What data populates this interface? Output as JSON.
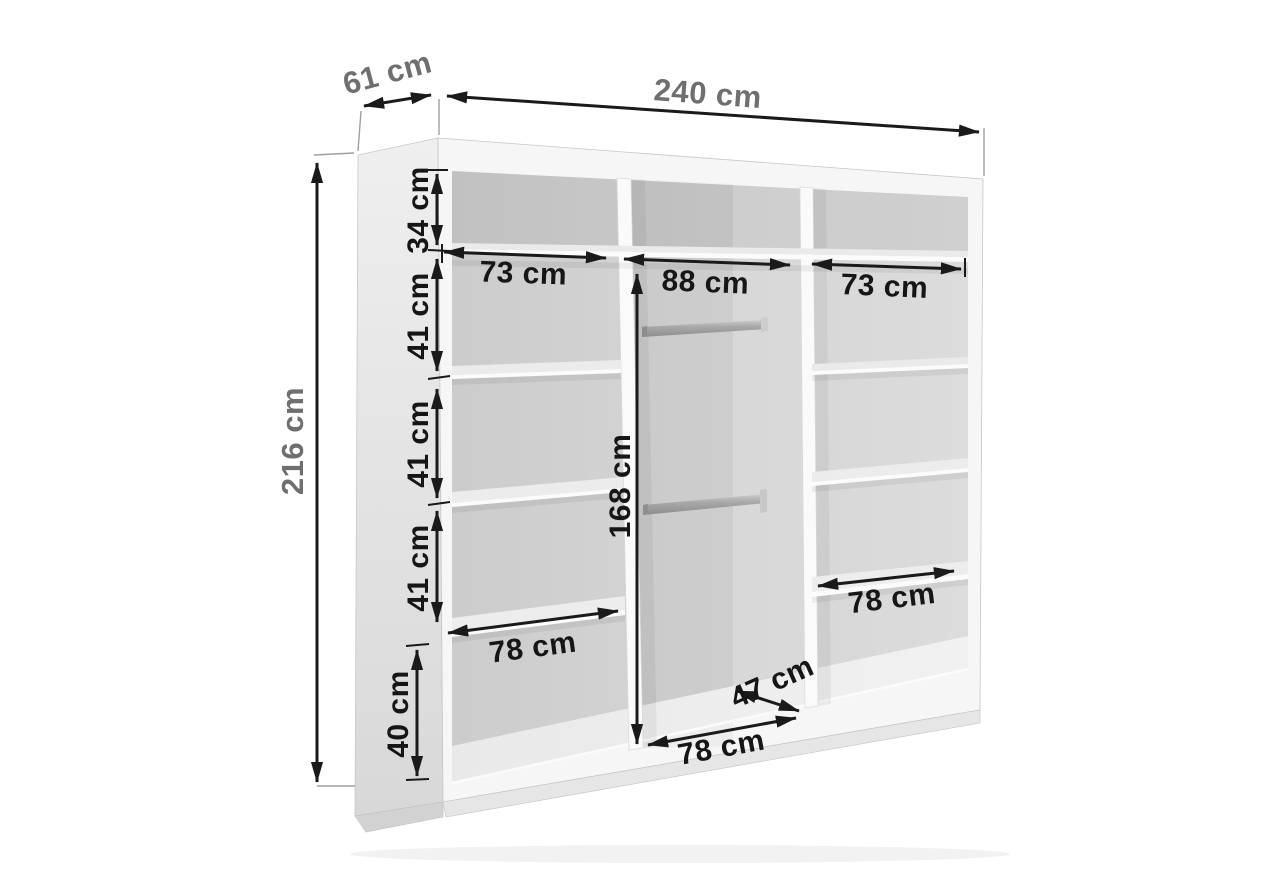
{
  "meta": {
    "subject": "wardrobe-interior-dimension-diagram",
    "units": "cm",
    "style": "grayscale 3D furniture render with dimension arrows"
  },
  "dims": {
    "width": "240 cm",
    "depth": "61 cm",
    "height": "216 cm",
    "top_section_height": "34 cm",
    "left_section_heights": [
      "41 cm",
      "41 cm",
      "41 cm"
    ],
    "left_bottom_height": "40 cm",
    "left_column_width": "73 cm",
    "middle_column_width": "88 cm",
    "right_column_width": "73 cm",
    "hanging_space_height": "168 cm",
    "left_shelf_width": "78 cm",
    "middle_floor_width": "78 cm",
    "middle_floor_depth": "47 cm",
    "right_shelf_width": "78 cm"
  },
  "colors": {
    "dimension_lines": "#1a1a1a",
    "interior_labels": "#161616",
    "exterior_labels": "#6f6f6f",
    "cabinet_front": "#f6f6f6",
    "cabinet_interior": "#d2d2d2",
    "background": "#ffffff"
  }
}
